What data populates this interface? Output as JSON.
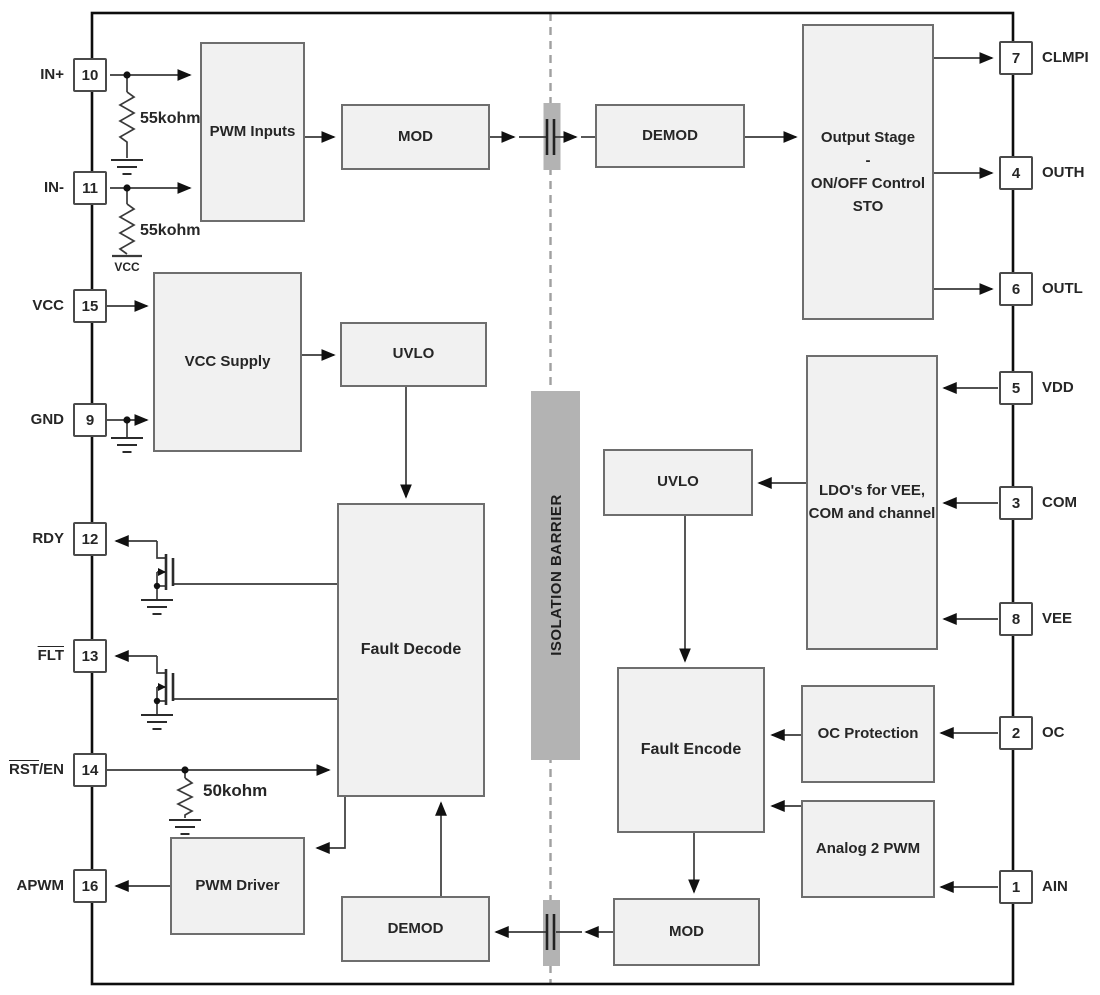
{
  "diagram": {
    "blocks": {
      "pwm_inputs": {
        "label": "PWM Inputs"
      },
      "mod_top": {
        "label": "MOD"
      },
      "demod_top": {
        "label": "DEMOD"
      },
      "output_stage": {
        "line1": "Output Stage",
        "line2": "-",
        "line3": "ON/OFF Control",
        "line4": "STO"
      },
      "vcc_supply": {
        "label": "VCC Supply"
      },
      "uvlo_left": {
        "label": "UVLO"
      },
      "fault_decode": {
        "label": "Fault Decode"
      },
      "uvlo_right": {
        "label": "UVLO"
      },
      "ldo": {
        "line1": "LDO's for VEE,",
        "line2": "COM and channel"
      },
      "fault_encode": {
        "label": "Fault Encode"
      },
      "oc_protection": {
        "label": "OC Protection"
      },
      "analog2pwm": {
        "label": "Analog 2 PWM"
      },
      "pwm_driver": {
        "label": "PWM Driver"
      },
      "demod_bottom": {
        "label": "DEMOD"
      },
      "mod_bottom": {
        "label": "MOD"
      }
    },
    "pins_left": [
      {
        "num": "10",
        "over": "",
        "name": "IN+"
      },
      {
        "num": "11",
        "over": "",
        "name": "IN-"
      },
      {
        "num": "15",
        "over": "",
        "name": "VCC"
      },
      {
        "num": "9",
        "over": "",
        "name": "GND"
      },
      {
        "num": "12",
        "over": "",
        "name": "RDY"
      },
      {
        "num": "13",
        "over": "FLT",
        "name": ""
      },
      {
        "num": "14",
        "over": "RST",
        "name": "/EN"
      },
      {
        "num": "16",
        "over": "",
        "name": "APWM"
      }
    ],
    "pins_right": [
      {
        "num": "7",
        "name": "CLMPI"
      },
      {
        "num": "4",
        "name": "OUTH"
      },
      {
        "num": "6",
        "name": "OUTL"
      },
      {
        "num": "5",
        "name": "VDD"
      },
      {
        "num": "3",
        "name": "COM"
      },
      {
        "num": "8",
        "name": "VEE"
      },
      {
        "num": "2",
        "name": "OC"
      },
      {
        "num": "1",
        "name": "AIN"
      }
    ],
    "annotations": {
      "res_in_plus": "55kohm",
      "res_in_minus": "55kohm",
      "res_rst": "50kohm",
      "vcc_rail": "VCC",
      "isolation_barrier": "ISOLATION BARRIER"
    },
    "colors": {
      "block_fill": "#f1f1f1",
      "block_border": "#6e6e6e",
      "barrier_gray": "#b3b3b3",
      "chip_border": "#0d0d0d",
      "wire": "#3a3a3a"
    }
  }
}
